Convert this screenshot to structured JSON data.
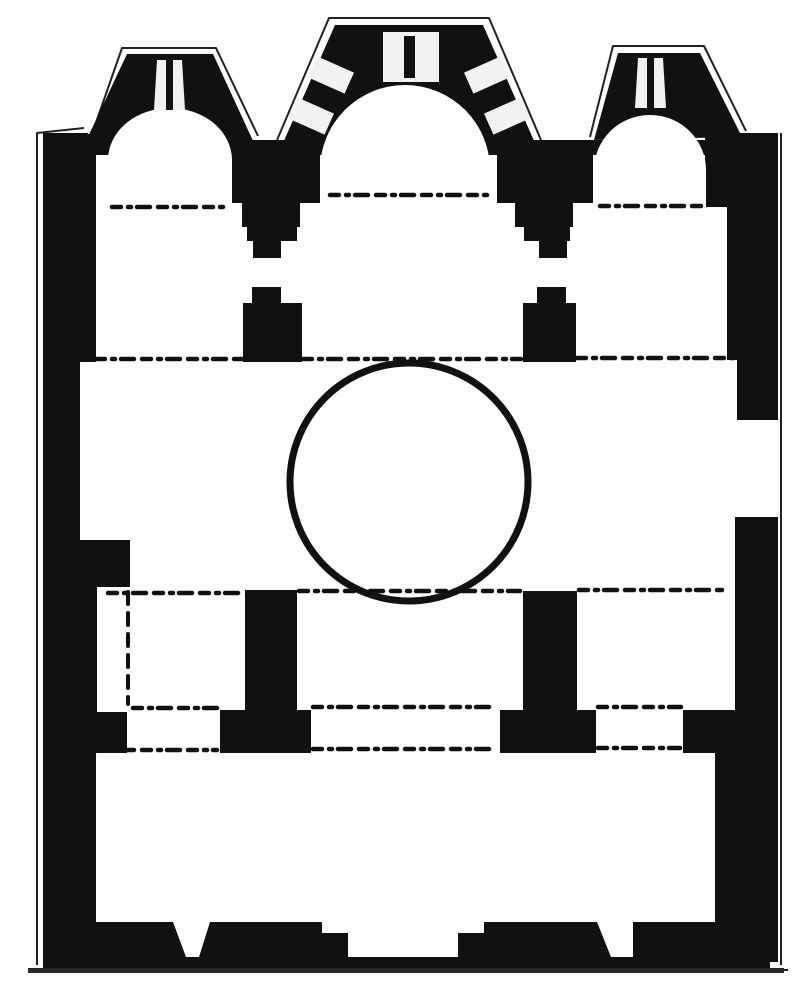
{
  "figure": {
    "kind": "architectural-floor-plan",
    "subject": "cross-in-square church plan with three apses, central dome circle, four piers, narthex with three doors"
  },
  "colors": {
    "ink": "#111111",
    "paper": "#fdfdfc",
    "window": "#f2f2f0",
    "contour": "#222222",
    "ground": "#272727"
  },
  "plan": {
    "canvas": {
      "w": 805,
      "h": 1000
    },
    "dash_pattern": "9 7 3 6 13 8",
    "shapes": [
      {
        "name": "outer-contour-left",
        "kind": "contour",
        "d": "M37,965 L37,133 L84,128"
      },
      {
        "name": "outer-contour-left-apse",
        "kind": "contour",
        "d": "M92,134 L122,48 L216,48 L258,136"
      },
      {
        "name": "outer-contour-central-apse",
        "kind": "contour",
        "d": "M277,140 L329,18 L489,18 L541,140"
      },
      {
        "name": "outer-contour-right-apse",
        "kind": "contour",
        "d": "M590,137 L613,46 L704,46 L746,131"
      },
      {
        "name": "outer-contour-right",
        "kind": "contour",
        "d": "M781,133 L781,965"
      },
      {
        "name": "outer-contour-bottom",
        "kind": "contour",
        "d": "M32,970 L788,970"
      },
      {
        "name": "north-wall-band",
        "kind": "rect",
        "x": 43,
        "y": 140,
        "w": 719,
        "h": 15
      },
      {
        "name": "north-wall-shoulder-west",
        "kind": "rect",
        "x": 43,
        "y": 133,
        "w": 45,
        "h": 9
      },
      {
        "name": "north-wall-shoulder-east",
        "kind": "rect",
        "x": 733,
        "y": 133,
        "w": 45,
        "h": 9
      },
      {
        "name": "west-apse-exterior",
        "kind": "poly",
        "pts": "86,141 127,54 213,54 254,143"
      },
      {
        "name": "central-apse-exterior",
        "kind": "poly",
        "pts": "283,143 335,25 483,25 535,143"
      },
      {
        "name": "east-apse-exterior",
        "kind": "poly",
        "pts": "594,140 618,53 700,53 742,137"
      },
      {
        "name": "left-wall",
        "kind": "rect",
        "x": 43,
        "y": 134,
        "w": 37,
        "h": 828
      },
      {
        "name": "left-wall-upper-inner",
        "kind": "rect",
        "x": 80,
        "y": 134,
        "w": 16,
        "h": 228
      },
      {
        "name": "left-wall-pilaster-a",
        "kind": "rect",
        "x": 80,
        "y": 540,
        "w": 50,
        "h": 47
      },
      {
        "name": "left-wall-mid-inner",
        "kind": "rect",
        "x": 80,
        "y": 587,
        "w": 17,
        "h": 125
      },
      {
        "name": "left-wall-pilaster-b",
        "kind": "rect",
        "x": 80,
        "y": 712,
        "w": 47,
        "h": 41
      },
      {
        "name": "left-wall-lower-inner",
        "kind": "rect",
        "x": 80,
        "y": 753,
        "w": 16,
        "h": 209
      },
      {
        "name": "right-wall-apse-flank",
        "kind": "rect",
        "x": 705,
        "y": 137,
        "w": 73,
        "h": 70
      },
      {
        "name": "right-wall-upper",
        "kind": "rect",
        "x": 727,
        "y": 207,
        "w": 51,
        "h": 153
      },
      {
        "name": "right-wall-mid",
        "kind": "rect",
        "x": 737,
        "y": 358,
        "w": 41,
        "h": 62
      },
      {
        "name": "right-wall-lower",
        "kind": "rect",
        "x": 735,
        "y": 517,
        "w": 43,
        "h": 195
      },
      {
        "name": "right-wall-respond",
        "kind": "rect",
        "x": 683,
        "y": 710,
        "w": 95,
        "h": 43
      },
      {
        "name": "right-wall-narthex",
        "kind": "rect",
        "x": 715,
        "y": 753,
        "w": 63,
        "h": 209
      },
      {
        "name": "respond-west-1",
        "kind": "rect",
        "x": 223,
        "y": 143,
        "w": 97,
        "h": 60
      },
      {
        "name": "respond-west-2",
        "kind": "rect",
        "x": 242,
        "y": 203,
        "w": 58,
        "h": 24
      },
      {
        "name": "respond-west-3",
        "kind": "rect",
        "x": 247,
        "y": 227,
        "w": 50,
        "h": 14
      },
      {
        "name": "respond-west-4",
        "kind": "rect",
        "x": 253,
        "y": 241,
        "w": 28,
        "h": 17
      },
      {
        "name": "respond-east-1",
        "kind": "rect",
        "x": 497,
        "y": 143,
        "w": 96,
        "h": 60
      },
      {
        "name": "respond-east-2",
        "kind": "rect",
        "x": 515,
        "y": 203,
        "w": 58,
        "h": 24
      },
      {
        "name": "respond-east-3",
        "kind": "rect",
        "x": 524,
        "y": 227,
        "w": 46,
        "h": 14
      },
      {
        "name": "respond-east-4",
        "kind": "rect",
        "x": 539,
        "y": 241,
        "w": 28,
        "h": 17
      },
      {
        "name": "pier-northwest-cap",
        "kind": "rect",
        "x": 252,
        "y": 287,
        "w": 29,
        "h": 18
      },
      {
        "name": "pier-northwest",
        "kind": "rect",
        "x": 243,
        "y": 303,
        "w": 59,
        "h": 59
      },
      {
        "name": "pier-northeast-cap",
        "kind": "rect",
        "x": 537,
        "y": 287,
        "w": 29,
        "h": 18
      },
      {
        "name": "pier-northeast",
        "kind": "rect",
        "x": 523,
        "y": 303,
        "w": 53,
        "h": 59
      },
      {
        "name": "pier-southwest-stem",
        "kind": "rect",
        "x": 245,
        "y": 590,
        "w": 52,
        "h": 122
      },
      {
        "name": "pier-southwest-base",
        "kind": "rect",
        "x": 220,
        "y": 710,
        "w": 91,
        "h": 43
      },
      {
        "name": "pier-southeast-stem",
        "kind": "rect",
        "x": 523,
        "y": 591,
        "w": 54,
        "h": 121
      },
      {
        "name": "pier-southeast-base",
        "kind": "rect",
        "x": 500,
        "y": 710,
        "w": 96,
        "h": 43
      },
      {
        "name": "south-wall-west-jamb",
        "kind": "poly",
        "pts": "95,922 173,922 186,957 95,957"
      },
      {
        "name": "south-wall-seg-a",
        "kind": "poly",
        "pts": "210,922 322,922 322,957 199,957"
      },
      {
        "name": "south-wall-step-a",
        "kind": "rect",
        "x": 322,
        "y": 933,
        "w": 26,
        "h": 24
      },
      {
        "name": "south-wall-step-b",
        "kind": "rect",
        "x": 458,
        "y": 933,
        "w": 26,
        "h": 24
      },
      {
        "name": "south-wall-seg-b",
        "kind": "poly",
        "pts": "484,922 597,922 611,957 484,957"
      },
      {
        "name": "south-wall-seg-c",
        "kind": "rect",
        "x": 633,
        "y": 922,
        "w": 137,
        "h": 40
      },
      {
        "name": "south-wall-outer",
        "kind": "rect",
        "x": 43,
        "y": 957,
        "w": 727,
        "h": 11
      },
      {
        "name": "ground-line",
        "kind": "rect",
        "x": 28,
        "y": 968,
        "w": 756,
        "h": 5,
        "fill": "ground"
      },
      {
        "name": "west-apse-interior",
        "kind": "path",
        "d": "M108,209 L108,160 A62,52 0 0 1 232,160 L232,209 Z",
        "fill": "paper"
      },
      {
        "name": "central-apse-interior",
        "kind": "path",
        "d": "M320,198 L320,170 A85,85 0 0 1 490,170 L490,198 Z",
        "fill": "paper"
      },
      {
        "name": "east-apse-interior",
        "kind": "path",
        "d": "M594,209 L594,170 A56,55 0 0 1 706,170 L706,209 Z",
        "fill": "paper"
      },
      {
        "name": "west-apse-window",
        "kind": "poly",
        "pts": "157,60 182,60 185,110 154,110",
        "fill": "window"
      },
      {
        "name": "west-apse-window-mullion",
        "kind": "rect",
        "x": 166,
        "y": 60,
        "w": 7,
        "h": 50
      },
      {
        "name": "east-apse-window",
        "kind": "poly",
        "pts": "638,58 663,58 666,108 635,108",
        "fill": "window"
      },
      {
        "name": "east-apse-window-mullion",
        "kind": "rect",
        "x": 647,
        "y": 58,
        "w": 7,
        "h": 50
      },
      {
        "name": "central-apse-window",
        "kind": "rect",
        "x": 383,
        "y": 32,
        "w": 56,
        "h": 50,
        "fill": "window"
      },
      {
        "name": "central-apse-window-mullion",
        "kind": "rect",
        "x": 404,
        "y": 36,
        "w": 11,
        "h": 42
      },
      {
        "name": "central-apse-side-window-sw-lower",
        "kind": "rotrect",
        "cx": 311,
        "cy": 116,
        "w": 23,
        "h": 40,
        "rot": -66,
        "fill": "window"
      },
      {
        "name": "central-apse-side-window-sw-upper",
        "kind": "rotrect",
        "cx": 331,
        "cy": 75,
        "w": 23,
        "h": 40,
        "rot": -66,
        "fill": "window"
      },
      {
        "name": "central-apse-side-window-se-upper",
        "kind": "rotrect",
        "cx": 487,
        "cy": 75,
        "w": 23,
        "h": 40,
        "rot": 66,
        "fill": "window"
      },
      {
        "name": "central-apse-side-window-se-lower",
        "kind": "rotrect",
        "cx": 507,
        "cy": 116,
        "w": 23,
        "h": 40,
        "rot": 66,
        "fill": "window"
      },
      {
        "name": "bema-arch-line-west",
        "kind": "dash",
        "x1": 112,
        "y1": 207,
        "x2": 224,
        "y2": 207
      },
      {
        "name": "central-apse-chord",
        "kind": "dash",
        "x1": 330,
        "y1": 195,
        "x2": 492,
        "y2": 195
      },
      {
        "name": "bema-arch-line-east",
        "kind": "dash",
        "x1": 600,
        "y1": 206,
        "x2": 706,
        "y2": 206
      },
      {
        "name": "north-arch-line-west",
        "kind": "dash",
        "x1": 96,
        "y1": 359,
        "x2": 242,
        "y2": 359
      },
      {
        "name": "north-arch-line-center",
        "kind": "dash",
        "x1": 303,
        "y1": 359,
        "x2": 521,
        "y2": 359
      },
      {
        "name": "north-arch-line-east",
        "kind": "dash",
        "x1": 577,
        "y1": 358,
        "x2": 736,
        "y2": 358
      },
      {
        "name": "south-arch-line-west",
        "kind": "dash",
        "x1": 108,
        "y1": 593,
        "x2": 243,
        "y2": 593
      },
      {
        "name": "south-arch-line-center",
        "kind": "dash",
        "x1": 299,
        "y1": 591,
        "x2": 520,
        "y2": 591
      },
      {
        "name": "south-arch-line-east",
        "kind": "dash",
        "x1": 579,
        "y1": 590,
        "x2": 722,
        "y2": 590
      },
      {
        "name": "narthex-arch-line-a",
        "kind": "dash",
        "x1": 133,
        "y1": 708,
        "x2": 217,
        "y2": 708
      },
      {
        "name": "narthex-arch-line-b",
        "kind": "dash",
        "x1": 313,
        "y1": 707,
        "x2": 497,
        "y2": 707
      },
      {
        "name": "narthex-arch-line-c",
        "kind": "dash",
        "x1": 598,
        "y1": 707,
        "x2": 681,
        "y2": 707
      },
      {
        "name": "narthex-arch-line-d",
        "kind": "dash",
        "x1": 96,
        "y1": 750,
        "x2": 217,
        "y2": 750
      },
      {
        "name": "narthex-arch-line-e",
        "kind": "dash",
        "x1": 313,
        "y1": 749,
        "x2": 496,
        "y2": 749
      },
      {
        "name": "narthex-arch-line-f",
        "kind": "dash",
        "x1": 598,
        "y1": 748,
        "x2": 680,
        "y2": 748
      },
      {
        "name": "wall-niche-open-side",
        "kind": "dash",
        "x1": 128,
        "y1": 592,
        "x2": 128,
        "y2": 704,
        "dash": "12 9",
        "w": 4
      },
      {
        "name": "dome-circle",
        "kind": "circle",
        "cx": 409,
        "cy": 482,
        "r": 119,
        "sw": 7
      }
    ]
  }
}
